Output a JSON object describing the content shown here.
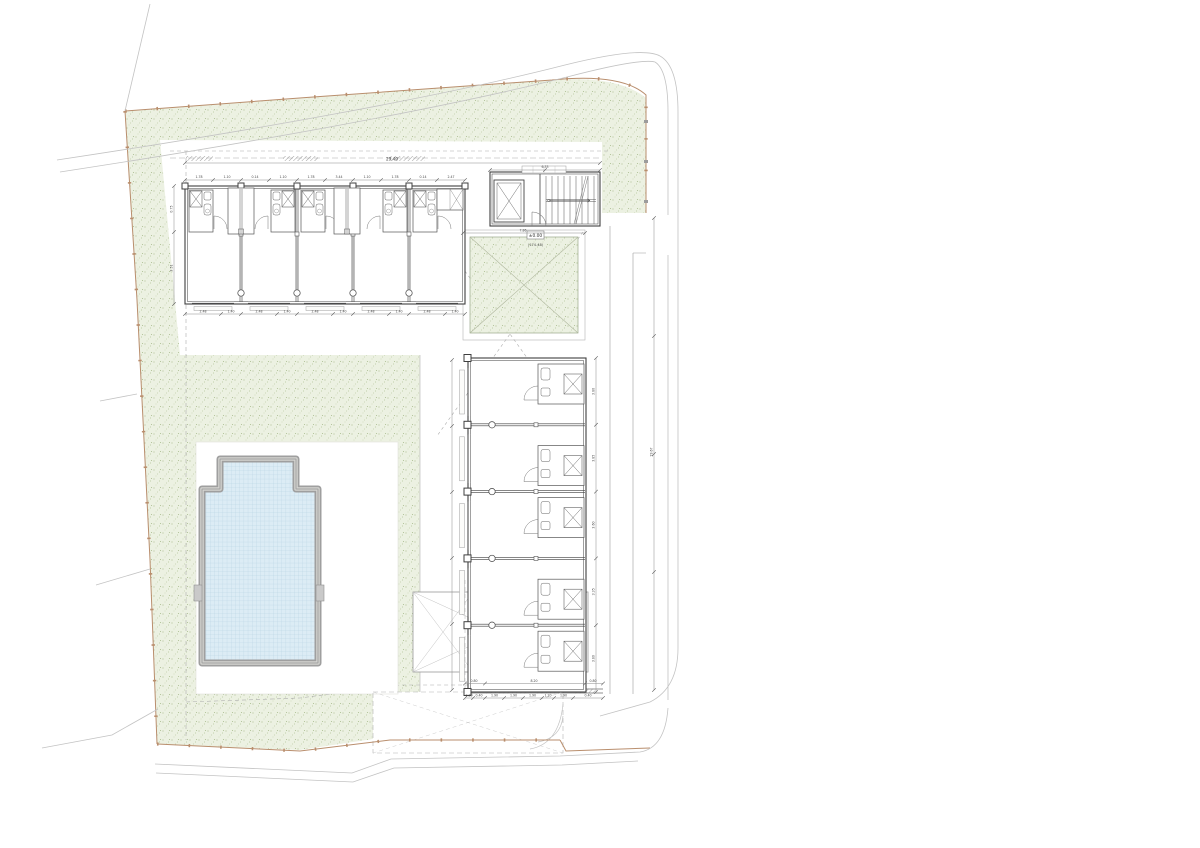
{
  "canvas": {
    "background": "#ffffff",
    "width": 1200,
    "height": 848
  },
  "palette": {
    "wall_line": "#3f3f3f",
    "detail_line": "#6f6f6f",
    "dimension_line": "#8a8a8a",
    "dimension_text": "#4a4a4a",
    "road_line": "#c3c3c3",
    "dashed_line": "#aeaeae",
    "boundary_fence": "#b98e6d",
    "green_fill": "#ecf1e2",
    "green_dot": "#b7c69e",
    "pool_water": "#dcecf5",
    "pool_grid": "#b4d0e2",
    "pool_frame": "#9f9f9f",
    "court_line": "#9c9c9c"
  },
  "site": {
    "level_label": "±0.00",
    "elevation_label": "(174.48)"
  },
  "building": {
    "top_wing_units": 5,
    "right_wing_units": 5,
    "top_wing_closets": 2,
    "stair_treads": 9
  },
  "dimensions": {
    "top_total": "29.40",
    "right_total": "29.67",
    "stair_width": "6.33",
    "garden_width": "7.86",
    "terrace_outer": [
      "0.80",
      "8.20",
      "0.80"
    ],
    "top_chain": [
      "1.78",
      "1.10",
      "0.14",
      "1.10",
      "1.78",
      "3.44",
      "1.10",
      "1.78",
      "0.14",
      "2.47"
    ],
    "top_bottom_chain": [
      "2.48",
      "1.40",
      "2.48",
      "1.40",
      "2.48",
      "1.40",
      "2.48",
      "1.40",
      "2.48",
      "1.40"
    ],
    "left_chain": [
      "0.75",
      "3.51"
    ],
    "right_wing_chain": [
      "3.80",
      "3.85",
      "3.60",
      "3.35",
      "3.80"
    ],
    "terrace_chain": [
      "0.80",
      "0.40",
      "1.90",
      "1.90",
      "1.90",
      "1.20",
      "1.90",
      "0.40"
    ]
  }
}
